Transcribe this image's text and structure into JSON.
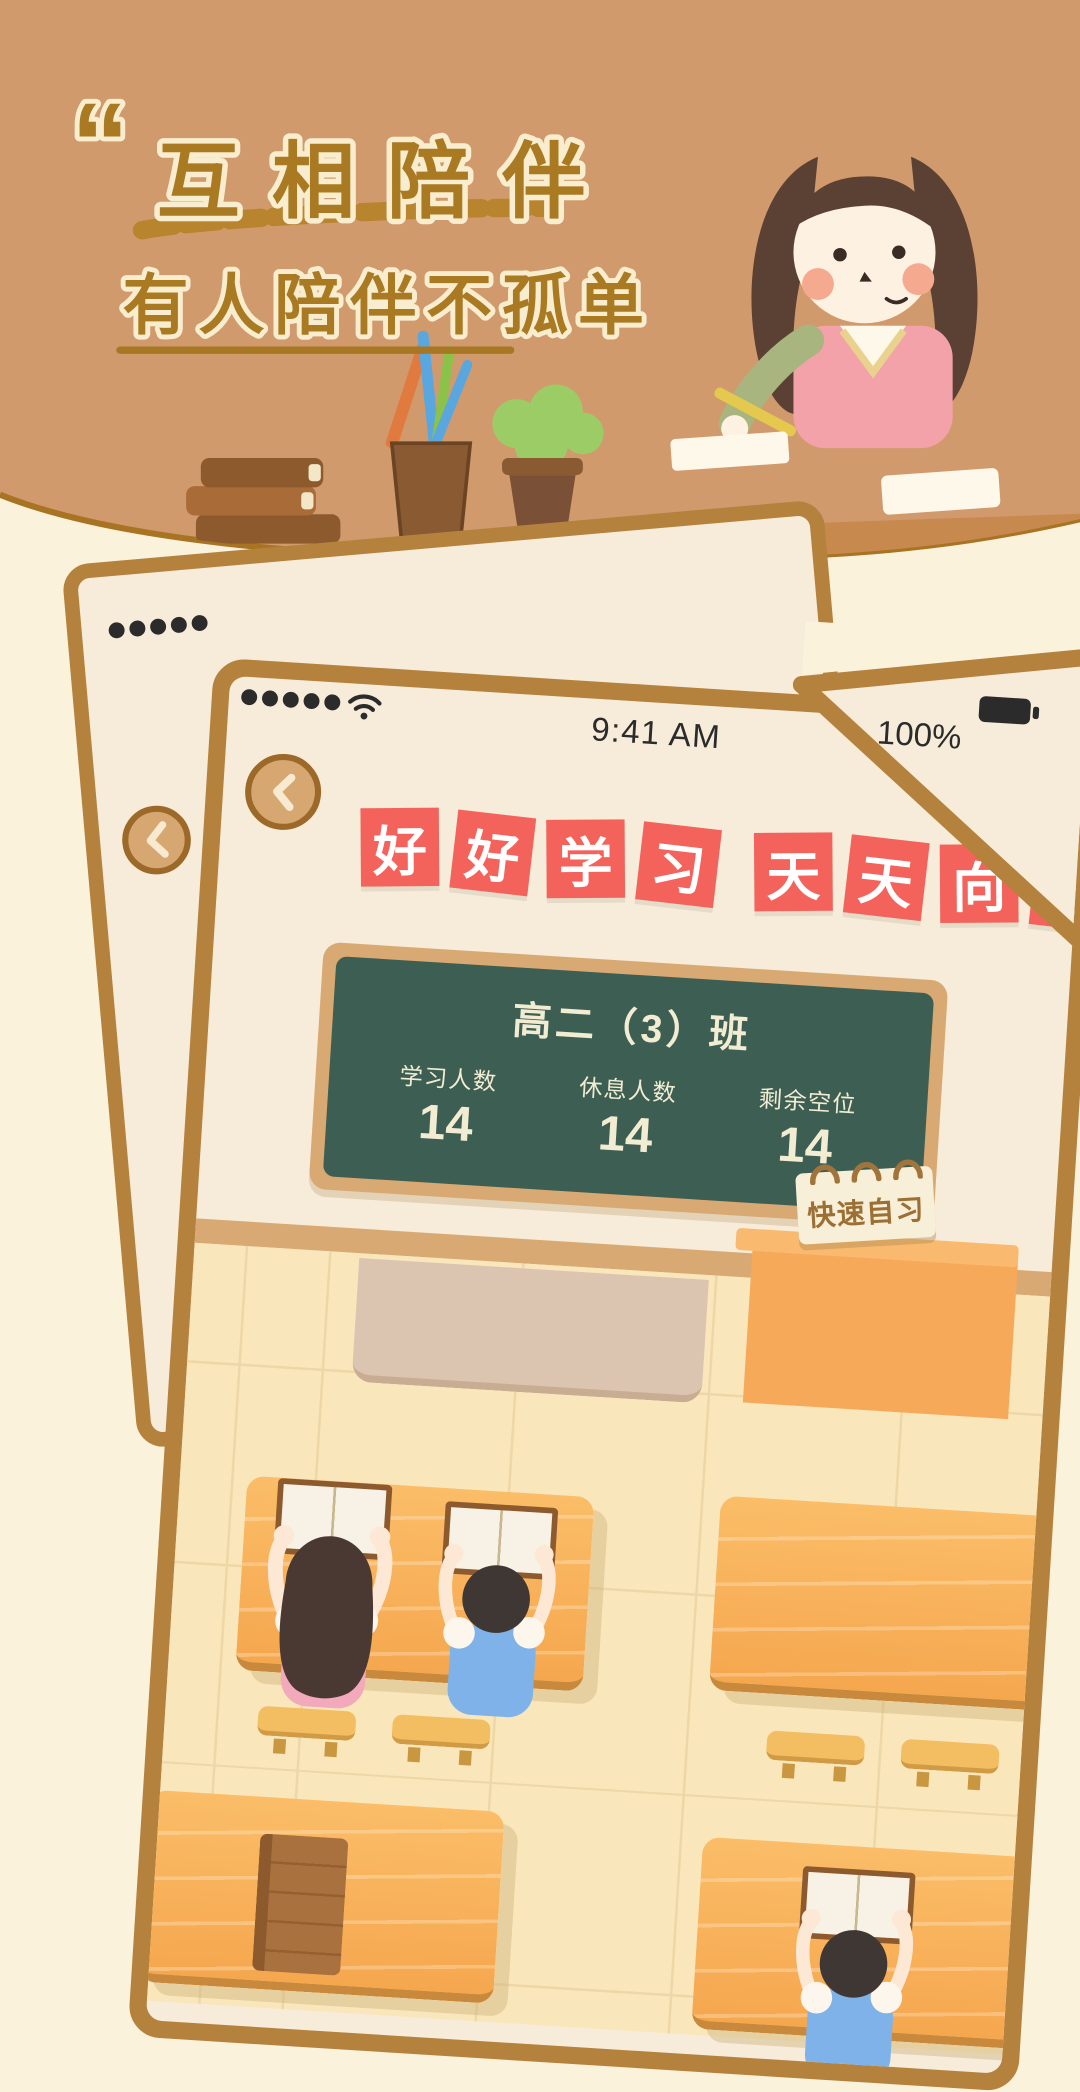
{
  "header": {
    "quote_mark": "“",
    "title": "互相陪伴",
    "subtitle": "有人陪伴不孤单"
  },
  "phone": {
    "status": {
      "time": "9:41 AM",
      "battery_percent": "100%",
      "signal_dots": 5
    },
    "banner_tiles": [
      "好",
      "好",
      "学",
      "习",
      "天",
      "天",
      "向",
      "上"
    ],
    "board": {
      "class_name": "高二（3）班",
      "stats": [
        {
          "label": "学习人数",
          "value": "14"
        },
        {
          "label": "休息人数",
          "value": "14"
        },
        {
          "label": "剩余空位",
          "value": "14"
        }
      ]
    },
    "quick_note_label": "快速自习"
  },
  "icons": {
    "wifi": "wifi-icon",
    "signal": "signal-dots-icon",
    "battery": "battery-icon",
    "back": "chevron-left-icon"
  },
  "colors": {
    "header_bg": "#d19a6c",
    "page_bg": "#fbf2dc",
    "accent_red": "#f4635b",
    "board_green": "#3d5e53",
    "frame_brown": "#b5823e",
    "title_brown": "#aa7a22",
    "desk_orange": "#f5a74e"
  }
}
